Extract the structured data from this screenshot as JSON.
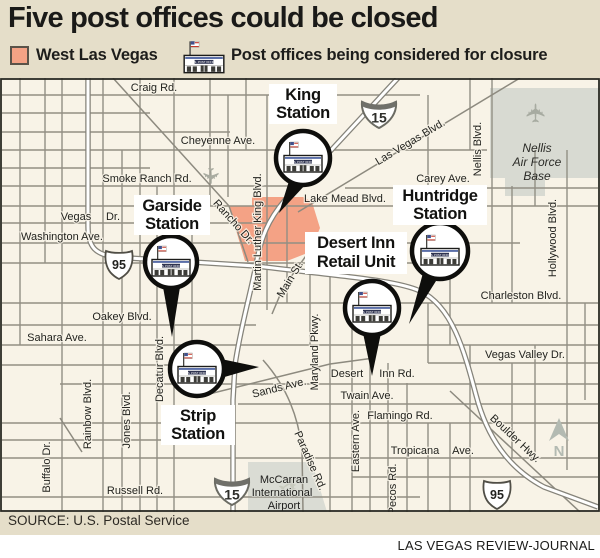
{
  "title": "Five post offices could be closed",
  "legend": {
    "west_las_vegas": "West Las Vegas",
    "closure": "Post offices being considered for closure"
  },
  "stations": {
    "king": {
      "line1": "King",
      "line2": "Station"
    },
    "garside": {
      "line1": "Garside",
      "line2": "Station"
    },
    "desert_inn": {
      "line1": "Desert Inn",
      "line2": "Retail Unit"
    },
    "huntridge": {
      "line1": "Huntridge",
      "line2": "Station"
    },
    "strip": {
      "line1": "Strip",
      "line2": "Station"
    }
  },
  "roads": {
    "craig": "Craig Rd.",
    "cheyenne": "Cheyenne Ave.",
    "smoke_ranch": "Smoke Ranch Rd.",
    "carey": "Carey Ave.",
    "lake_mead": "Lake Mead Blvd.",
    "vegas": "Vegas",
    "vegas_dr": "Dr.",
    "washington": "Washington Ave.",
    "charleston": "Charleston Blvd.",
    "oakey": "Oakey Blvd.",
    "sahara": "Sahara Ave.",
    "vegas_valley": "Vegas Valley Dr.",
    "desert": "Desert",
    "inn_rd": "Inn Rd.",
    "twain": "Twain Ave.",
    "flamingo": "Flamingo Rd.",
    "tropicana": "Tropicana",
    "tropicana_ave": "Ave.",
    "russell": "Russell Rd.",
    "mlk": "Martin Luther King Blvd.",
    "main": "Main St.",
    "maryland": "Maryland Pkwy.",
    "eastern": "Eastern Ave.",
    "pecos": "Pecos Rd.",
    "paradise": "Paradise Rd.",
    "decatur": "Decatur Blvd.",
    "jones": "Jones Blvd.",
    "rainbow": "Rainbow Blvd.",
    "buffalo": "Buffalo Dr.",
    "nellis_blvd": "Nellis  Blvd.",
    "hollywood": "Hollywood Blvd.",
    "rancho": "Rancho Dr.",
    "las_vegas_blvd": "Las Vegas Blvd.",
    "boulder": "Boulder Hwy.",
    "sands": "Sands Ave."
  },
  "areas": {
    "nellis1": "Nellis",
    "nellis2": "Air Force",
    "nellis3": "Base",
    "mccarran1": "McCarran",
    "mccarran2": "International",
    "mccarran3": "Airport"
  },
  "shields": {
    "i15": "15",
    "us95": "95"
  },
  "po_sign": "U.S. POST OFFICE",
  "compass_n": "N",
  "source": "SOURCE: U.S. Postal Service",
  "credit": "LAS VEGAS REVIEW-JOURNAL",
  "colors": {
    "west_las_vegas": "#f4a285",
    "map_bg": "#f8f3e7",
    "header_bg": "#e5dec9",
    "base_gray": "#d8dad2",
    "road_gray": "#928f84"
  }
}
